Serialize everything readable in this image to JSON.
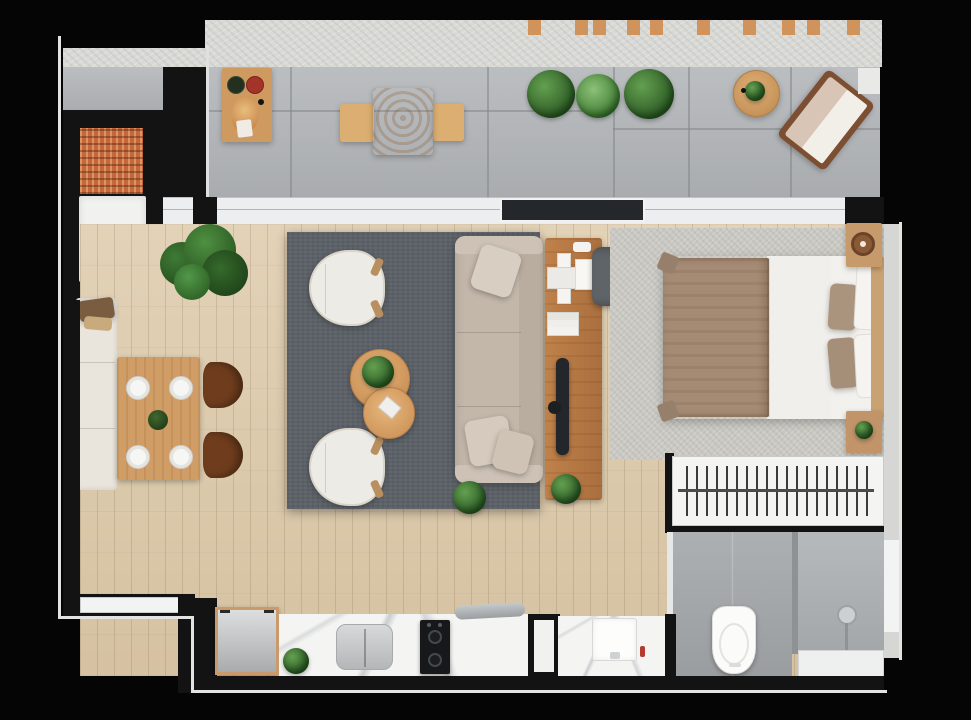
{
  "canvas": {
    "width": 971,
    "height": 720
  },
  "scene": {
    "type": "apartment-floor-plan-render",
    "view": "top-down",
    "background": "#050505"
  },
  "palette": {
    "outer_black": "#050505",
    "wall_black": "#131313",
    "exterior_trim": "#e3e3e1",
    "concrete_wall": "#d9d9d6",
    "terrace_tile": "#b2b5b8",
    "wood_floor": "#dcc8a7",
    "living_rug": "#5b6167",
    "bedroom_rug": "#cac9c3",
    "bathroom_tile": "#a3a7aa",
    "marble_counter": "#f4f4f3",
    "closet_white": "#f4f4f3",
    "sofa_beige": "#c3b7aa",
    "armchair_white": "#edebe5",
    "table_wood": "#d09d66",
    "console_wood": "#b4763f",
    "bed_blanket_brown": "#a58b74",
    "bed_linen_white": "#f1efeb",
    "grill_brick_orange": "#c4683c",
    "dining_chair_brown": "#6f3d1d",
    "plant_green": "#3d7d38",
    "accent_red_plate": "#a2342a"
  },
  "rooms": [
    {
      "id": "terrace",
      "name": "balcony terrace",
      "furniture": [
        "grill-station",
        "grill-counter",
        "serving-board",
        "dark-plate",
        "red-plate",
        "bread-board",
        "bar-table",
        "bar-bench-left",
        "bar-bench-right",
        "planter-plants",
        "round-mat-with-plant",
        "sun-lounger",
        "pergola-beams",
        "concrete-parapet"
      ]
    },
    {
      "id": "dining",
      "name": "dining area",
      "furniture": [
        "wall-bench",
        "bench-pillows",
        "dining-table",
        "four-place-settings",
        "centerpiece-plant",
        "dining-chair-upper",
        "dining-chair-lower",
        "monstera-plant"
      ]
    },
    {
      "id": "living",
      "name": "living area",
      "furniture": [
        "area-rug",
        "armchair-upper",
        "armchair-lower",
        "coffee-table-large",
        "coffee-table-small",
        "table-plant",
        "book",
        "sofa",
        "sofa-pillows",
        "floor-plants"
      ]
    },
    {
      "id": "workspace",
      "name": "desk / media console",
      "furniture": [
        "wood-console",
        "laptop",
        "notepad",
        "tray",
        "book-stack",
        "tv-panel",
        "speaker",
        "desk-chair",
        "console-plant"
      ]
    },
    {
      "id": "bedroom",
      "name": "bedroom",
      "furniture": [
        "area-rug",
        "double-bed",
        "brown-blanket",
        "white-duvet",
        "pillows",
        "headboard",
        "nightstand-upper-with-tray",
        "nightstand-lower-with-plant",
        "wardrobe-rail-closet"
      ]
    },
    {
      "id": "bathroom",
      "name": "bathroom",
      "furniture": [
        "toilet",
        "walk-in-shower",
        "shower-head",
        "bench-ledge",
        "vanity-counter",
        "vanity-sink",
        "soap-dispenser",
        "door"
      ]
    },
    {
      "id": "kitchen",
      "name": "kitchenette",
      "furniture": [
        "refrigerator",
        "marble-counter",
        "kitchen-sink",
        "faucet",
        "two-burner-cooktop",
        "counter-plant"
      ]
    }
  ],
  "glazing": {
    "terrace_doors": [
      "glass-left",
      "dark-sliding-panel",
      "glass-right"
    ],
    "windows": [
      "bottom-left-window",
      "east-wall-window"
    ]
  }
}
